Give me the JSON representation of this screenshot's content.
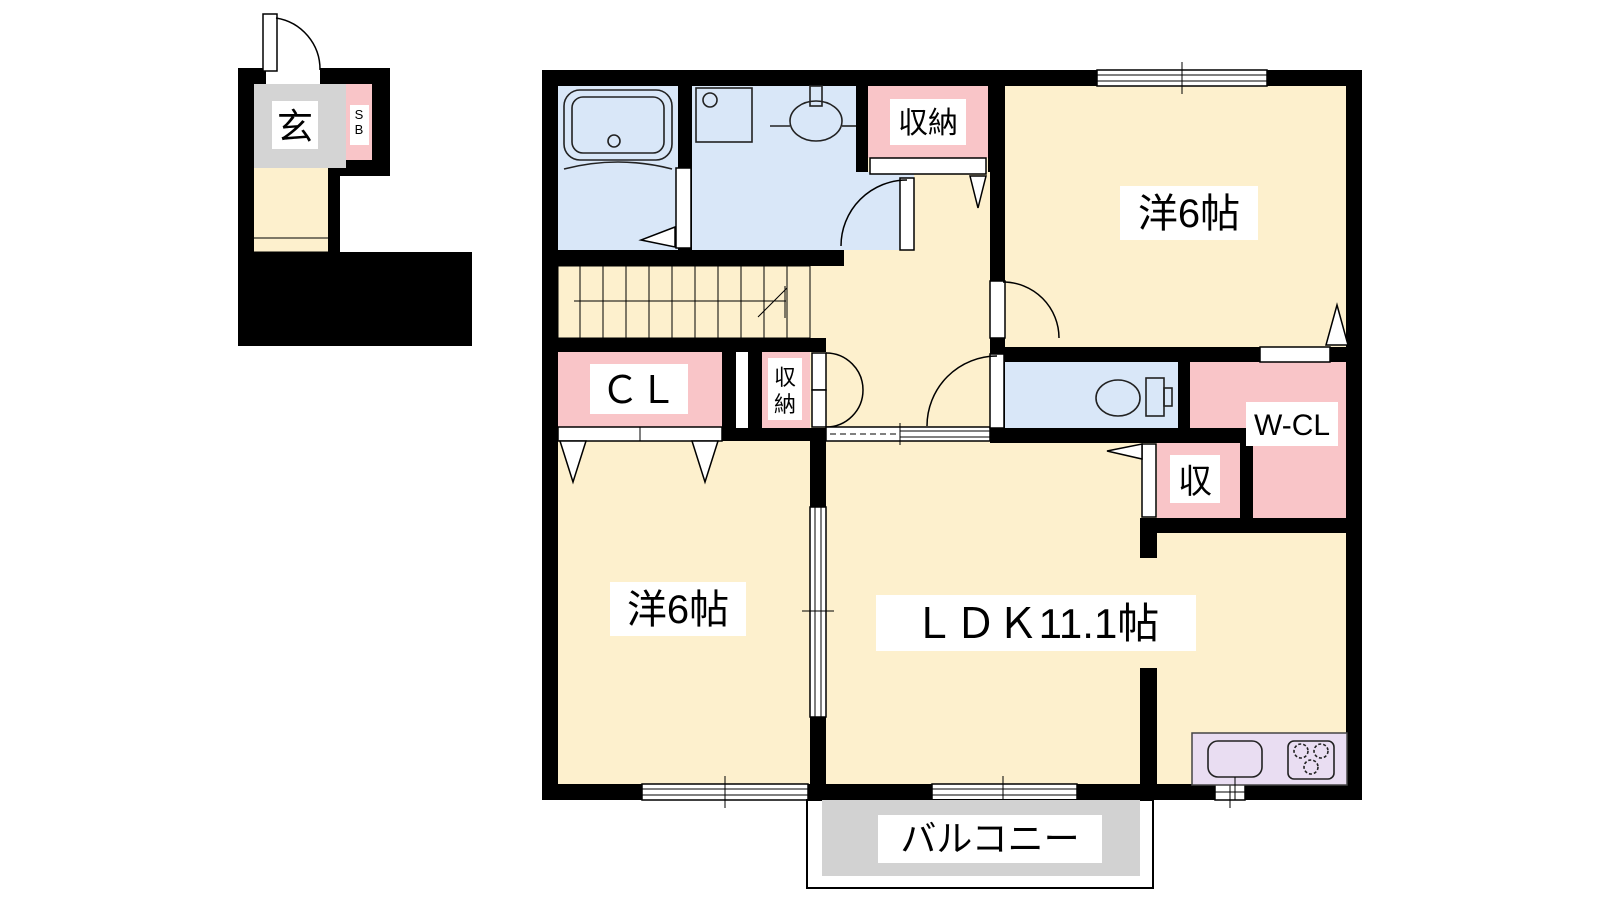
{
  "plan": {
    "labels": {
      "genkan": "玄",
      "sb_line1": "S",
      "sb_line2": "B",
      "storage_top": "収納",
      "room_top_right": "洋6帖",
      "closet_cl": "ＣＬ",
      "storage_hall_line1": "収",
      "storage_hall_line2": "納",
      "walk_in_closet": "W-CL",
      "storage_small": "収",
      "room_bottom_left": "洋6帖",
      "ldk": "ＬＤＫ11.1帖",
      "balcony": "バルコニー"
    },
    "colors": {
      "wall": "#000000",
      "room_floor": "#fdf0cd",
      "wet_area": "#d9e7f8",
      "closet": "#f9c5c8",
      "stairs": "#ecd9b2",
      "entrance_floor": "#d4d4d4",
      "balcony_deck": "#d2d2d2",
      "kitchen_counter": "#e9ddf2"
    }
  }
}
